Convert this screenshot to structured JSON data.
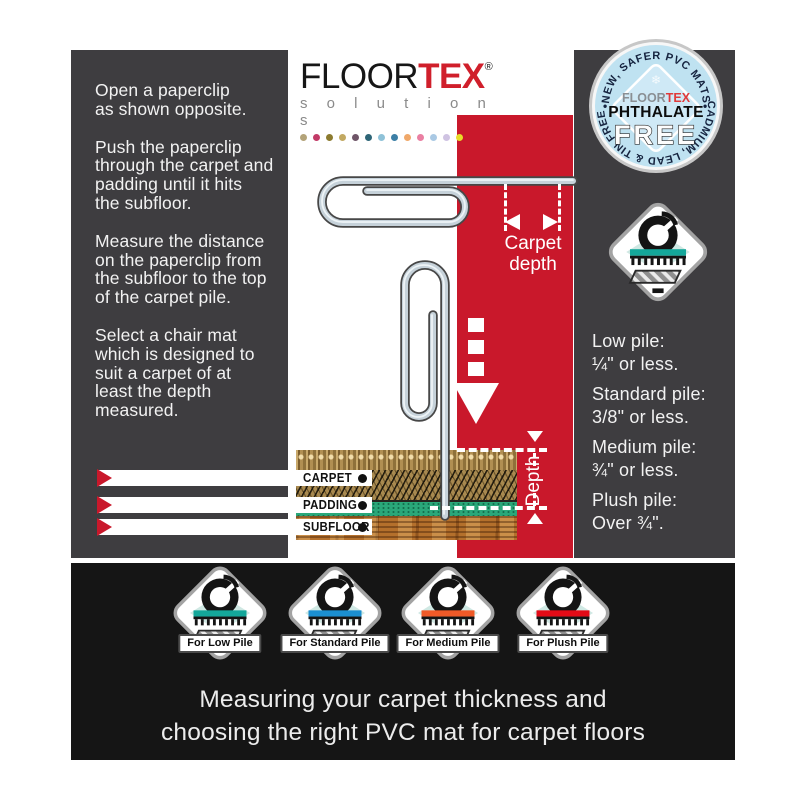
{
  "colors": {
    "panel_bg": "#3e3d40",
    "red_band": "#c9182b",
    "bottom_bar": "#151515",
    "badge_blue": "#bfe2f1",
    "teal_band": "#14a79a",
    "blue_band": "#1b8fd1",
    "orange_band": "#f05a28",
    "red_band_icon": "#e30b17"
  },
  "instructions": {
    "paragraphs": [
      "Open a paperclip\nas shown opposite.",
      "Push the paperclip\nthrough the carpet and\npadding until it hits\nthe subfloor.",
      "Measure the distance\non the paperclip from\nthe subfloor to the top\nof the carpet pile.",
      "Select a chair mat\nwhich is designed to\nsuit a carpet of at\nleast the depth\nmeasured."
    ]
  },
  "logo": {
    "floor": "FLOOR",
    "tex": "TEX",
    "reg": "®",
    "subtitle": "s o l u t i o n s",
    "dots": [
      "#b3a379",
      "#c23a67",
      "#8c7b2f",
      "#c2a962",
      "#6f5568",
      "#2e6577",
      "#8fc2d8",
      "#3c7fa6",
      "#f0a86a",
      "#ea7fa2",
      "#aac9e4",
      "#cfc3e2",
      "#e8dc28"
    ]
  },
  "badge": {
    "arc_top": "NEW, SAFER PVC MATS",
    "arc_bottom": "CADMIUM, LEAD & TIN FREE",
    "sep": "•",
    "brand_floor": "FLOOR",
    "brand_tex": "TEX",
    "line1": "PHTHALATE",
    "line2": "FREE",
    "snowflake": "❄"
  },
  "measure": {
    "carpet_depth_line1": "Carpet",
    "carpet_depth_line2": "depth",
    "depth": "Depth"
  },
  "cross_section": {
    "labels": [
      "CARPET",
      "PADDING",
      "SUBFLOOR"
    ]
  },
  "pile_guide": {
    "items": [
      {
        "name": "Low pile:",
        "spec": "¼\" or less."
      },
      {
        "name": "Standard pile:",
        "spec": "3/8\" or less."
      },
      {
        "name": "Medium pile:",
        "spec": "¾\" or less."
      },
      {
        "name": "Plush pile:",
        "spec": "Over ¾\"."
      }
    ]
  },
  "mat_icons": [
    {
      "label": "For Low Pile",
      "band": "#14a79a"
    },
    {
      "label": "For Standard Pile",
      "band": "#1b8fd1"
    },
    {
      "label": "For Medium Pile",
      "band": "#f05a28"
    },
    {
      "label": "For Plush Pile",
      "band": "#e30b17"
    }
  ],
  "right_icon": {
    "band": "#14a79a"
  },
  "caption": {
    "line1": "Measuring your carpet thickness and",
    "line2": "choosing the right PVC mat for carpet floors"
  }
}
